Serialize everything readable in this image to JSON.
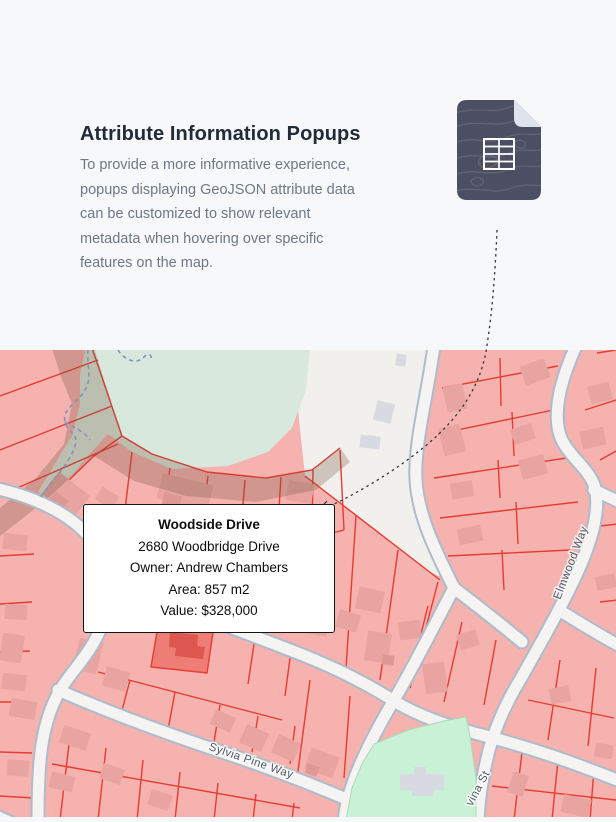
{
  "header": {
    "title": "Attribute Information Popups",
    "description_lines": [
      "To provide a more informative experience,",
      "popups displaying GeoJSON attribute data",
      "can be customized to show relevant",
      "metadata when hovering over specific",
      "features on the map."
    ]
  },
  "icons": {
    "file_icon": "geojson-attribute-table-document"
  },
  "map": {
    "popup": {
      "title": "Woodside Drive",
      "address": "2680 Woodbridge Drive",
      "owner": "Owner: Andrew Chambers",
      "area": "Area: 857 m2",
      "value": "Value: $328,000"
    },
    "street_labels": {
      "sylvia": "Sylvia Pine Way",
      "elmwood": "Elmwood Way",
      "vina": "vina St"
    }
  },
  "colors": {
    "page_bg": "#f7f8fa",
    "heading_text": "#212b3a",
    "body_text": "#6f7887",
    "icon_dark": "#4c4f63",
    "icon_fold": "#dfe3ec",
    "parcel_fill": "#f5b2ae",
    "parcel_stroke": "#e63c32",
    "building_fill": "#e7a4a1",
    "highlight_parcel": "#ee7d75",
    "highlight_building": "#dd564f",
    "park_sage": "#d8e8dd",
    "park_mint": "#c9f1d5",
    "street_fill": "#f5f4f2",
    "street_casing": "#adbcca",
    "trail_blue": "#7e93bf",
    "label_text": "#4d5966",
    "leader_line": "#33383f"
  }
}
